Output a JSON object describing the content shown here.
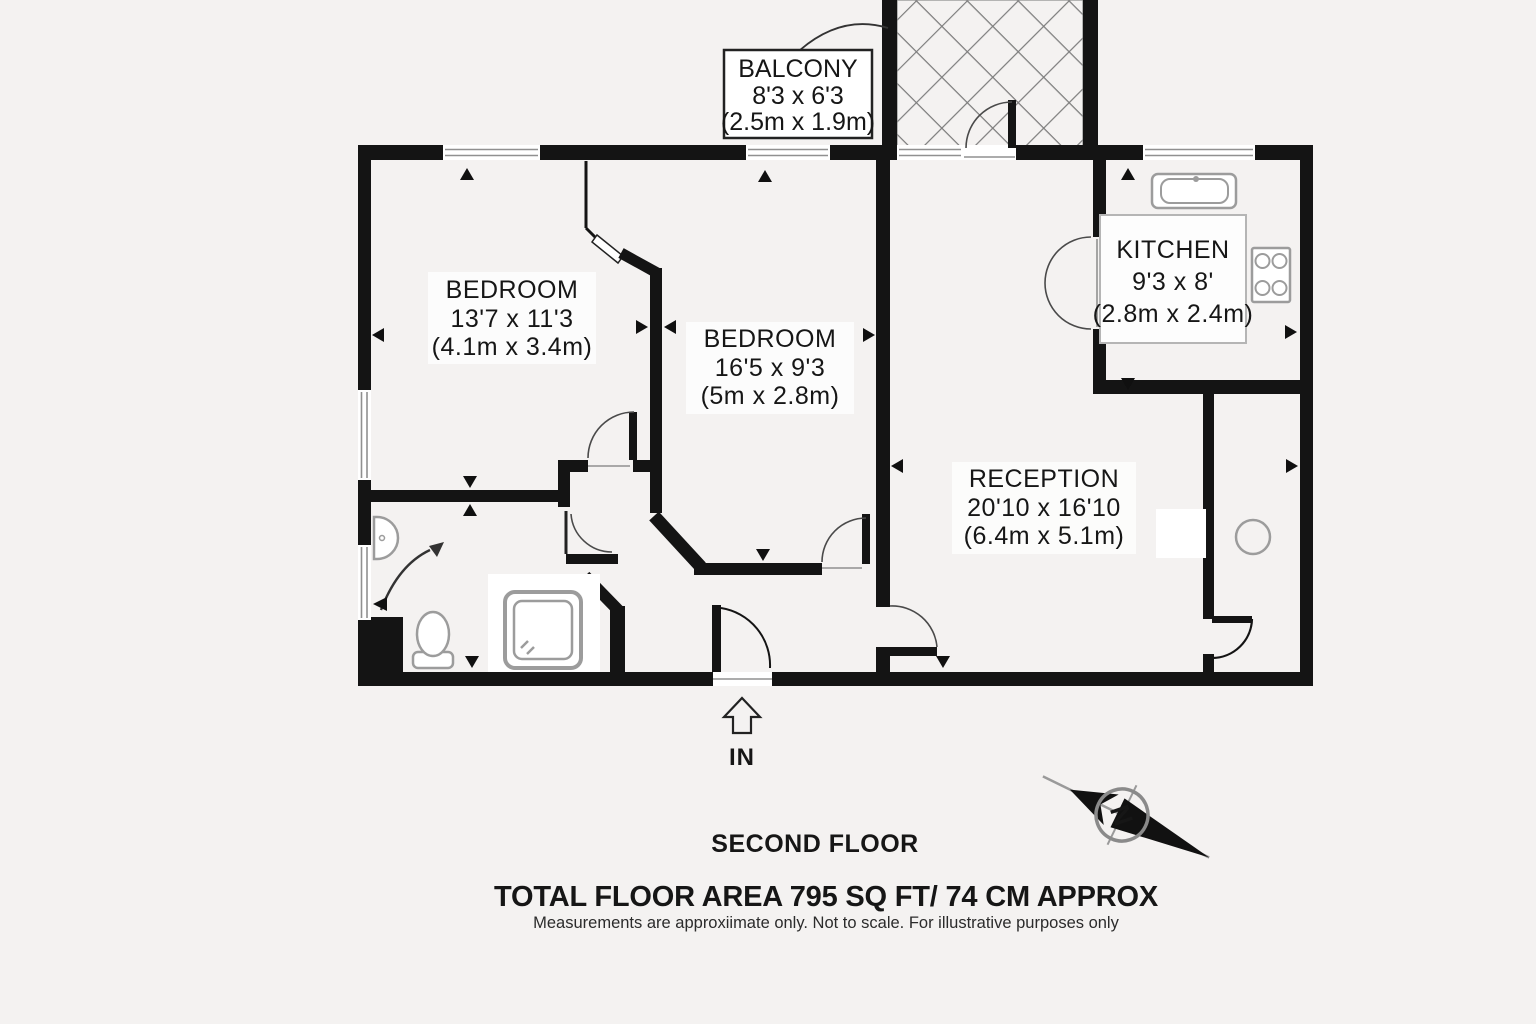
{
  "page": {
    "background": "#f4f2f1",
    "wall_color": "#141414",
    "fixture_color": "#9c9c9c"
  },
  "plan": {
    "rooms": {
      "bedroom1": {
        "name": "BEDROOM",
        "imperial": "13'7 x 11'3",
        "metric": "(4.1m x 3.4m)"
      },
      "bedroom2": {
        "name": "BEDROOM",
        "imperial": "16'5 x 9'3",
        "metric": "(5m x 2.8m)"
      },
      "kitchen": {
        "name": "KITCHEN",
        "imperial": "9'3 x 8'",
        "metric": "(2.8m x 2.4m)"
      },
      "reception": {
        "name": "RECEPTION",
        "imperial": "20'10 x 16'10",
        "metric": "(6.4m x 5.1m)"
      },
      "balcony": {
        "name": "BALCONY",
        "imperial": "8'3 x 6'3",
        "metric": "(2.5m x 1.9m)"
      }
    },
    "entrance_label": "IN",
    "compass_north_label": "N"
  },
  "footer": {
    "floor_label": "SECOND FLOOR",
    "area_label": "TOTAL FLOOR AREA  795 SQ FT/ 74 CM APPROX",
    "disclaimer": "Measurements are approxiimate only. Not to scale. For illustrative purposes only"
  }
}
